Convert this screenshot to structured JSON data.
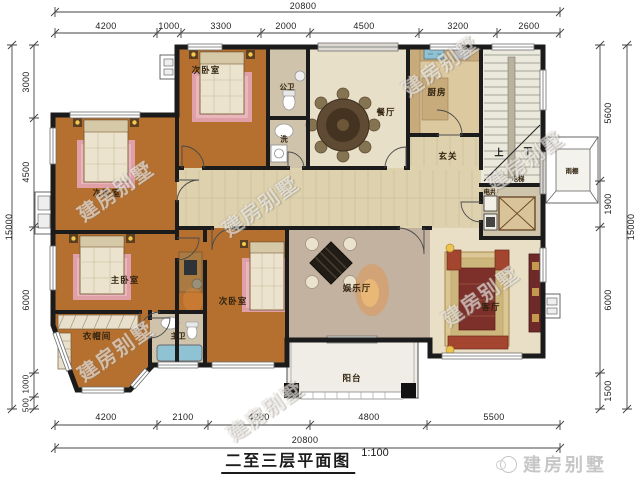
{
  "title": {
    "text": "二至三层平面图",
    "scale": "1:100"
  },
  "brand": {
    "text": "建房别墅"
  },
  "watermark": {
    "text": "建房别墅"
  },
  "dims": {
    "top_total": "20800",
    "bottom_total": "20800",
    "left_total": "15000",
    "right_total": "15000",
    "top": [
      "4200",
      "1000",
      "3300",
      "2000",
      "4500",
      "3200",
      "2600"
    ],
    "bottom": [
      "4200",
      "2100",
      "4200",
      "4800",
      "5500"
    ],
    "left": [
      "3000",
      "4500",
      "6000",
      "1000",
      "500"
    ],
    "right": [
      "5600",
      "1900",
      "6000",
      "1500"
    ]
  },
  "rooms": {
    "bedroom_top": "次卧室",
    "public_bath": "公卫",
    "laundry": "洗",
    "dining": "餐厅",
    "kitchen": "厨房",
    "foyer": "玄关",
    "stairs_up": "上",
    "stairs_down": "下",
    "elevator": "电梯",
    "shaft": "电井",
    "canopy": "雨棚",
    "bedroom_left": "次卧室",
    "master_bedroom": "主卧室",
    "closet": "衣帽间",
    "master_bath": "主卫",
    "bedroom_center": "次卧室",
    "entertainment": "娱乐厅",
    "living": "客厅",
    "balcony": "阳台"
  }
}
